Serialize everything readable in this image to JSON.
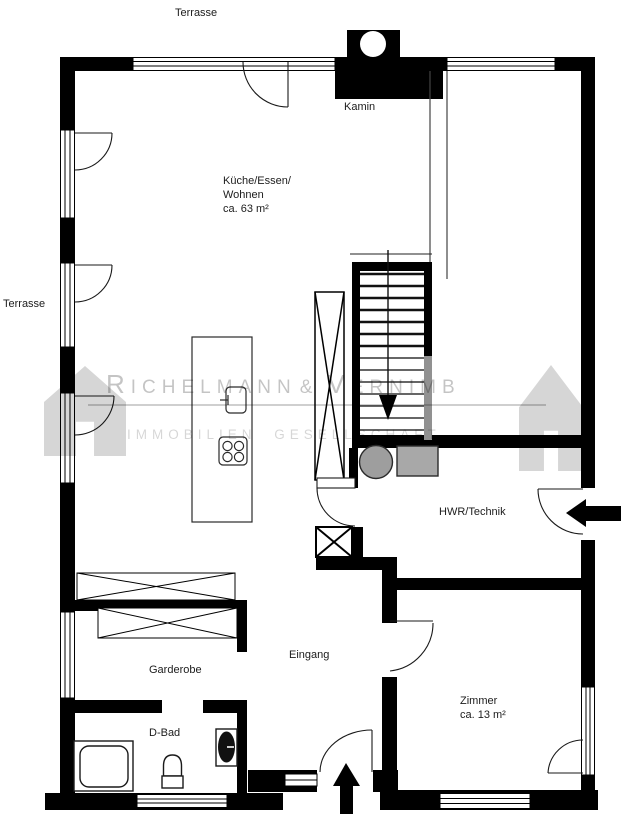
{
  "type": "floor_plan",
  "rooms": {
    "terrasse_top": "Terrasse",
    "terrasse_left": "Terrasse",
    "kamin": "Kamin",
    "kueche_line1": "Küche/Essen/",
    "kueche_line2": "Wohnen",
    "kueche_line3": "ca. 63 m²",
    "hwr": "HWR/Technik",
    "garderobe": "Garderobe",
    "eingang": "Eingang",
    "dbad": "D-Bad",
    "zimmer_line1": "Zimmer",
    "zimmer_line2": "ca. 13 m²"
  },
  "watermark": {
    "initial1": "R",
    "word1": "ICHELMANN",
    "ampersand": "&",
    "initial2": "V",
    "word2": "ERNIMB",
    "line2": "IMMOBILIEN GESELLSCHAFT"
  },
  "colors": {
    "walls": "#000000",
    "appliance_gray": "#a0a0a0",
    "stair_shadow_gray": "#919191",
    "watermark_gray": "#c6c6c6"
  }
}
